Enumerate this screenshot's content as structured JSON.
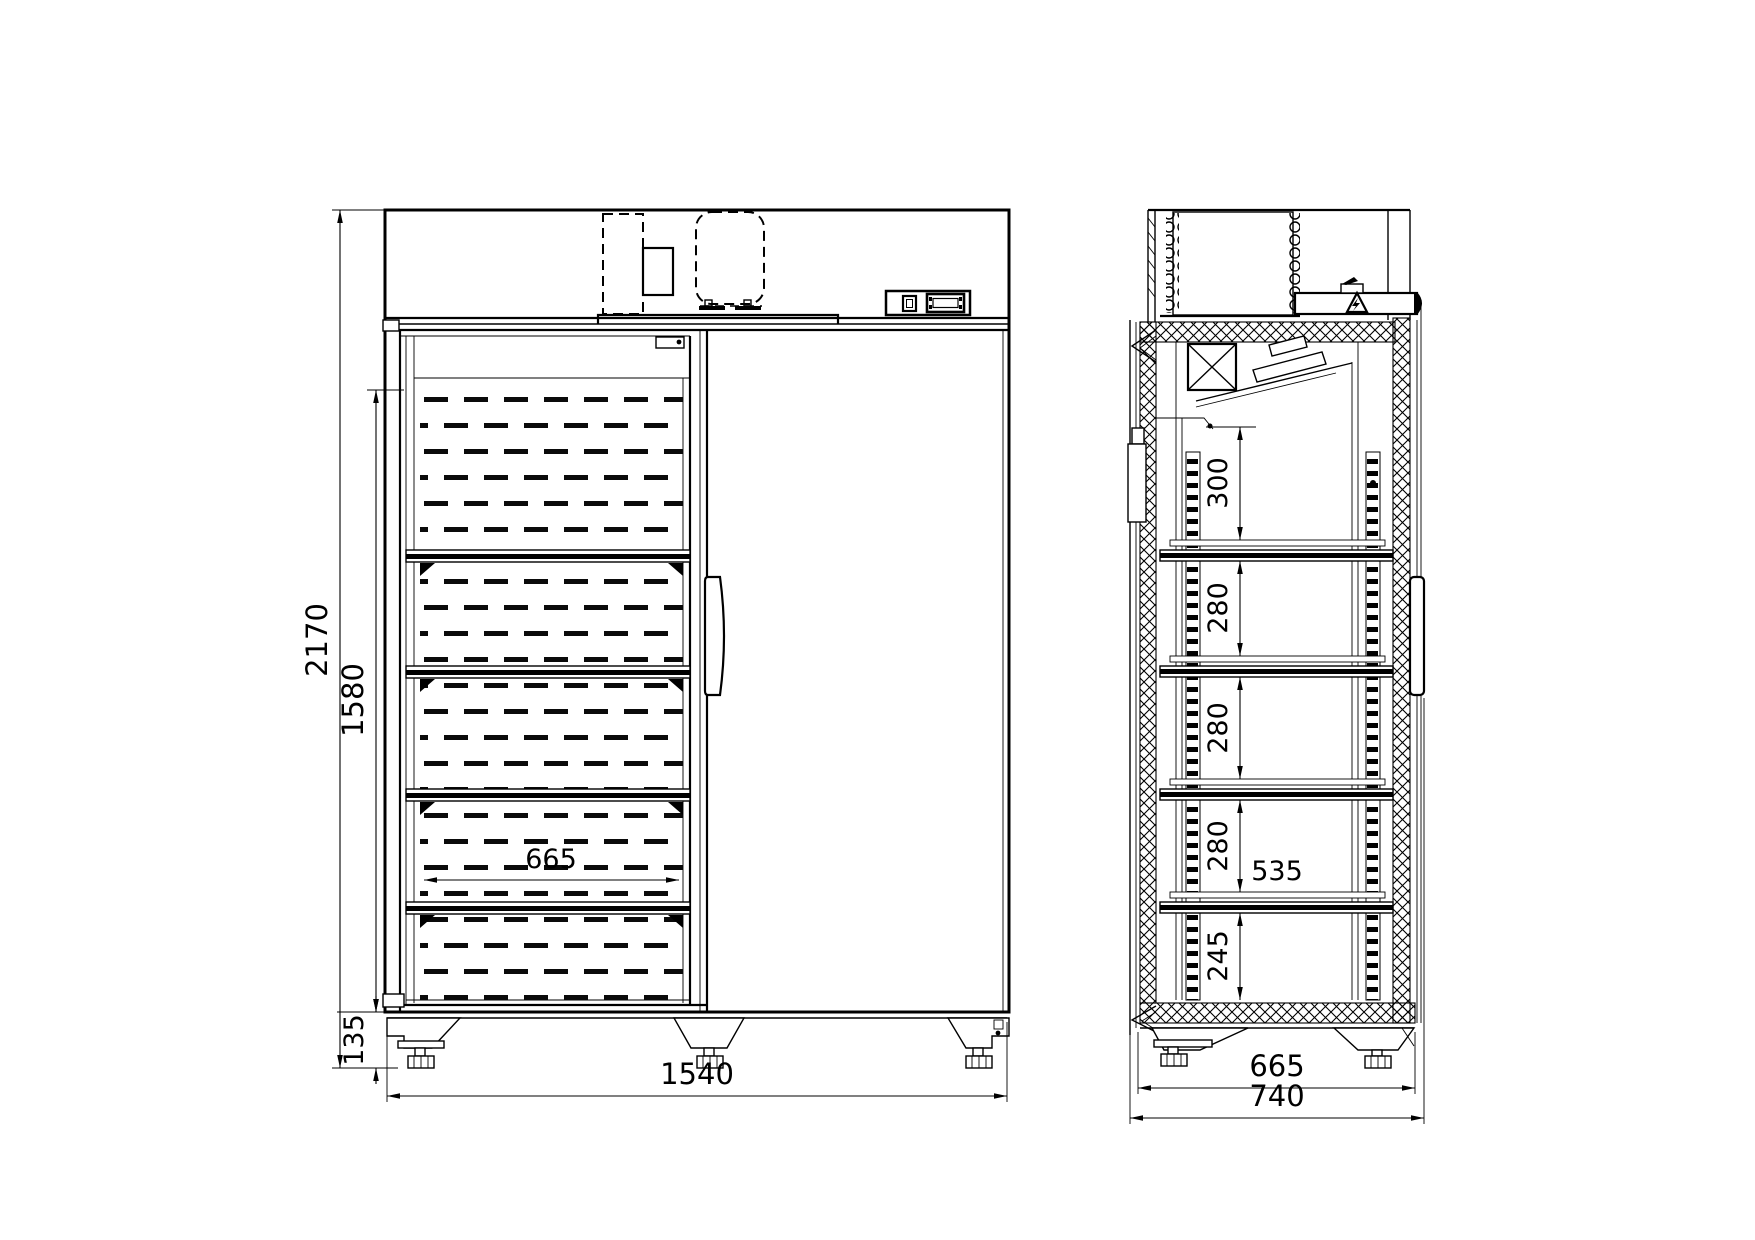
{
  "drawing": {
    "background": "#ffffff",
    "line_color": "#000000",
    "views": {
      "front": {
        "dims": {
          "overall_height": "2170",
          "door_opening_height": "1580",
          "base_height": "135",
          "shelf_width": "665",
          "overall_width": "1540"
        }
      },
      "side": {
        "dims": {
          "top_shelf_gap": "300",
          "shelf_gap_2": "280",
          "shelf_gap_3": "280",
          "shelf_gap_4": "280",
          "bottom_shelf_gap": "245",
          "shelf_depth": "535",
          "interior_depth": "665",
          "overall_depth": "740"
        }
      }
    }
  }
}
